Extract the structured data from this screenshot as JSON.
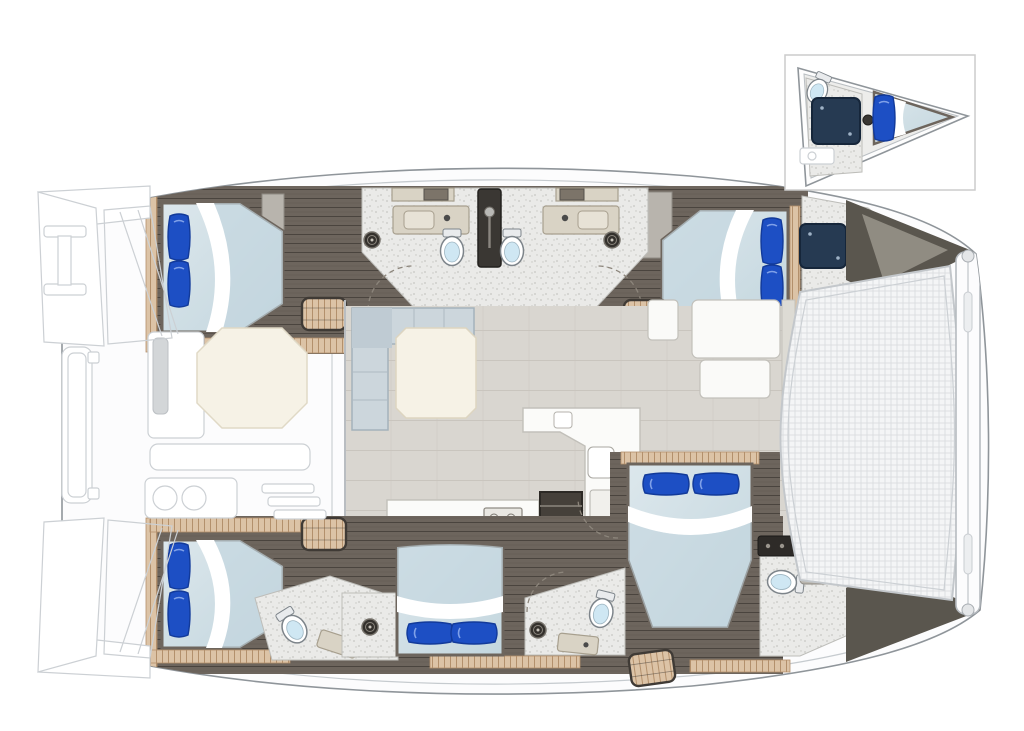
{
  "figure": {
    "kind": "catamaran-interior-deck-plan",
    "view": "top-down floor plan with bow detail inset"
  },
  "areas": [
    "aft-swim-platforms",
    "aft-cockpit",
    "salon",
    "galley",
    "port-aft-cabin",
    "port-heads",
    "port-forward-cabin",
    "starboard-aft-cabin",
    "starboard-mid-cabin",
    "owner-cabin",
    "ensuite-bathrooms",
    "bow-trampoline",
    "forward-crossbeam",
    "forepeak-crew-cabin-inset"
  ],
  "counts": {
    "double-beds": 5,
    "toilets": 5,
    "inset-toilets": 1,
    "shower-drains": 6,
    "stair-bundles": 4
  },
  "colors": {
    "hullFill": "#fcfcfd",
    "hullStroke": "#8f959a",
    "hullInner": "#c6cbcf",
    "faint": "#ccd0d4",
    "wood": "#6d655d",
    "woodDark": "#4a443e",
    "woodDoor": "#7c7469",
    "teak": "#dcc3a6",
    "teakDark": "#b3906c",
    "bath": "#eaeae8",
    "speck": "#c7c7c3",
    "salon": "#d9d6d0",
    "salonLine": "#c9c5be",
    "mattress": "#dce7ec",
    "mattressDeep": "#c3d6de",
    "sheet": "#ffffff",
    "pillow": "#1d4fc4",
    "pillowDark": "#123a9a",
    "sofa": "#ccd6dc",
    "sofaStroke": "#a4b2bb",
    "cream": "#f6f2e6",
    "creamStroke": "#ddd5c0",
    "navy": "#263a52",
    "navyStroke": "#16263a",
    "stair": "#45403a",
    "tramp": "#f4f5f6",
    "trampLine": "#d7dadd",
    "toiletLid": "#cfe7f3",
    "wedge": "#5a564e",
    "wedgeLight": "#908c82",
    "cabinetGray": "#b8b4ad",
    "insetBorder": "#cccccc"
  }
}
